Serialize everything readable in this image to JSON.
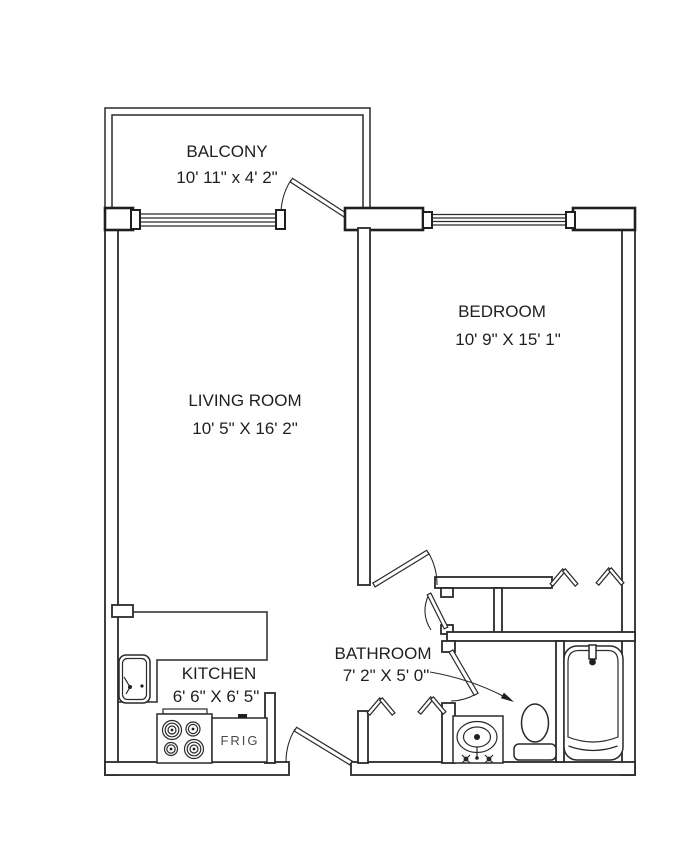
{
  "page": {
    "background": "#ffffff",
    "line_color": "#2a2a2a",
    "text_color": "#1f1f1f"
  },
  "floor_plan": {
    "rooms": [
      {
        "id": "balcony",
        "name": "BALCONY",
        "dimensions": "10' 11\" x 4' 2\""
      },
      {
        "id": "bedroom",
        "name": "BEDROOM",
        "dimensions": "10' 9\" X 15' 1\""
      },
      {
        "id": "living-room",
        "name": "LIVING ROOM",
        "dimensions": "10' 5\" X 16' 2\""
      },
      {
        "id": "kitchen",
        "name": "KITCHEN",
        "dimensions": "6' 6\" X 6' 5\""
      },
      {
        "id": "bathroom",
        "name": "BATHROOM",
        "dimensions": "7' 2\" X 5' 0\""
      }
    ],
    "appliances": {
      "fridge_label": "FRIG"
    }
  }
}
